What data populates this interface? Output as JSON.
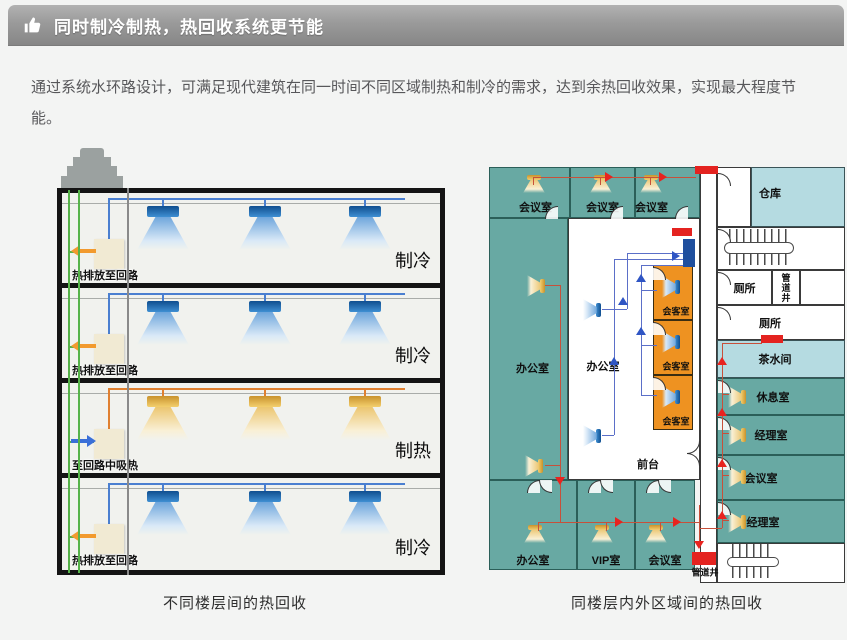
{
  "header": {
    "title": "同时制冷制热，热回收系统更节能"
  },
  "intro": {
    "text": "通过系统水环路设计，可满足现代建筑在同一时间不同区域制热和制冷的需求，达到余热回收效果，实现最大程度节能。"
  },
  "colors": {
    "header_grad_top": "#b2b2b2",
    "header_grad_bottom": "#868686",
    "page_bg": "#f3f4f3",
    "building_outline": "#141414",
    "green_pipe": "#57b34a",
    "gray_riser": "#8a8a8a",
    "cool_pipe": "#4a7fd0",
    "heat_pipe": "#e08030",
    "exchanger_box": "#f1ead3",
    "cool_arrow": "#f29a2e",
    "heat_arrow": "#3a6fd8",
    "teal_room": "#68a9a3",
    "ltblue_room": "#b5dbe1",
    "orange_room": "#ee9221",
    "loop_line_red": "#c7503a",
    "loop_line_blue": "#5b6fc8",
    "arrow_red": "#e8231f",
    "arrow_blue": "#2f55c4",
    "damper_red": "#e42320",
    "damper_blue": "#1f4f9e"
  },
  "left_diagram": {
    "caption": "不同楼层间的热回收",
    "floors": [
      {
        "mode": "制冷",
        "note": "热排放至回路",
        "variant": "cool"
      },
      {
        "mode": "制冷",
        "note": "热排放至回路",
        "variant": "cool"
      },
      {
        "mode": "制热",
        "note": "至回路中吸热",
        "variant": "heat"
      },
      {
        "mode": "制冷",
        "note": "热排放至回路",
        "variant": "cool"
      }
    ]
  },
  "right_diagram": {
    "caption": "同楼层内外区域间的热回收",
    "rooms": [
      {
        "label": "会议室",
        "x": 0,
        "y": 2,
        "w": 81,
        "h": 51,
        "fill": "teal",
        "ldx": 6,
        "ldy": 14,
        "cones": [
          {
            "x": 33,
            "y": 7,
            "c": "gold",
            "dir": "down"
          }
        ]
      },
      {
        "label": "会议室",
        "x": 81,
        "y": 2,
        "w": 65,
        "h": 51,
        "fill": "teal",
        "ldx": 0,
        "ldy": 14,
        "cones": [
          {
            "x": 19,
            "y": 7,
            "c": "gold",
            "dir": "down"
          }
        ]
      },
      {
        "label": "会议室",
        "x": 146,
        "y": 2,
        "w": 65,
        "h": 51,
        "fill": "teal",
        "ldx": -16,
        "ldy": 14,
        "cones": [
          {
            "x": 4,
            "y": 7,
            "c": "gold",
            "dir": "down"
          }
        ]
      },
      {
        "label": "办公室",
        "x": 0,
        "y": 53,
        "w": 79,
        "h": 262,
        "fill": "teal",
        "ldx": 4,
        "ldy": 19,
        "cones": [
          {
            "x": 35,
            "y": 58,
            "c": "gold",
            "dir": "side"
          },
          {
            "x": 33,
            "y": 238,
            "c": "gold",
            "dir": "side"
          }
        ]
      },
      {
        "label": "办公室",
        "x": 79,
        "y": 53,
        "w": 132,
        "h": 262,
        "fill": "white",
        "ldx": -31,
        "ldy": 17,
        "cones": [
          {
            "x": 12,
            "y": 82,
            "c": "blue",
            "dir": "side"
          },
          {
            "x": 12,
            "y": 208,
            "c": "blue",
            "dir": "side"
          }
        ]
      },
      {
        "label": "",
        "x": 211,
        "y": 2,
        "w": 17,
        "h": 416,
        "fill": "white"
      },
      {
        "label": "会客室",
        "x": 164,
        "y": 100,
        "w": 40,
        "h": 55,
        "fill": "orange",
        "fs": 9,
        "ldx": 3,
        "ldy": 18,
        "cones": [
          {
            "x": 6,
            "y": 12,
            "c": "blue",
            "dir": "side"
          }
        ]
      },
      {
        "label": "会客室",
        "x": 164,
        "y": 155,
        "w": 40,
        "h": 55,
        "fill": "orange",
        "fs": 9,
        "ldx": 3,
        "ldy": 18,
        "cones": [
          {
            "x": 6,
            "y": 12,
            "c": "blue",
            "dir": "side"
          }
        ]
      },
      {
        "label": "会客室",
        "x": 164,
        "y": 210,
        "w": 40,
        "h": 55,
        "fill": "orange",
        "fs": 9,
        "ldx": 3,
        "ldy": 18,
        "cones": [
          {
            "x": 6,
            "y": 12,
            "c": "blue",
            "dir": "side"
          }
        ]
      },
      {
        "label": "办公室",
        "x": 0,
        "y": 315,
        "w": 88,
        "h": 90,
        "fill": "teal",
        "ldy": 35,
        "cones": [
          {
            "x": 34,
            "y": 44,
            "c": "gold",
            "dir": "down"
          }
        ]
      },
      {
        "label": "VIP室",
        "x": 88,
        "y": 315,
        "w": 58,
        "h": 90,
        "fill": "teal",
        "ldy": 35,
        "cones": [
          {
            "x": 13,
            "y": 44,
            "c": "gold",
            "dir": "down"
          }
        ]
      },
      {
        "label": "会议室",
        "x": 146,
        "y": 315,
        "w": 60,
        "h": 90,
        "fill": "teal",
        "ldy": 35,
        "cones": [
          {
            "x": 9,
            "y": 44,
            "c": "gold",
            "dir": "down"
          }
        ]
      },
      {
        "label": "",
        "x": 228,
        "y": 2,
        "w": 34,
        "h": 60,
        "fill": "white"
      },
      {
        "label": "仓库",
        "x": 262,
        "y": 2,
        "w": 94,
        "h": 60,
        "fill": "ltblue",
        "ldx": -28,
        "ldy": -4
      },
      {
        "label": "",
        "x": 228,
        "y": 62,
        "w": 128,
        "h": 43,
        "fill": "white"
      },
      {
        "label": "厕所",
        "x": 228,
        "y": 105,
        "w": 55,
        "h": 35,
        "fill": "white"
      },
      {
        "label": "管道井",
        "x": 283,
        "y": 105,
        "w": 28,
        "h": 35,
        "fill": "white",
        "vertical": true,
        "fs": 9
      },
      {
        "label": "",
        "x": 311,
        "y": 105,
        "w": 45,
        "h": 35,
        "fill": "white"
      },
      {
        "label": "厕所",
        "x": 228,
        "y": 140,
        "w": 128,
        "h": 35,
        "fill": "white",
        "ldx": -11
      },
      {
        "label": "茶水间",
        "x": 228,
        "y": 175,
        "w": 128,
        "h": 38,
        "fill": "ltblue",
        "ldx": -6
      },
      {
        "label": "休息室",
        "x": 228,
        "y": 213,
        "w": 128,
        "h": 37,
        "fill": "teal",
        "ldx": -8,
        "cones": [
          {
            "x": 8,
            "y": 9,
            "c": "gold",
            "dir": "side"
          }
        ]
      },
      {
        "label": "经理室",
        "x": 228,
        "y": 250,
        "w": 128,
        "h": 40,
        "fill": "teal",
        "ldx": -10,
        "cones": [
          {
            "x": 8,
            "y": 10,
            "c": "gold",
            "dir": "side"
          }
        ]
      },
      {
        "label": "会议室",
        "x": 228,
        "y": 290,
        "w": 128,
        "h": 45,
        "fill": "teal",
        "ldx": -20,
        "cones": [
          {
            "x": 8,
            "y": 12,
            "c": "gold",
            "dir": "side"
          }
        ]
      },
      {
        "label": "经理室",
        "x": 228,
        "y": 335,
        "w": 128,
        "h": 43,
        "fill": "teal",
        "ldx": -18,
        "cones": [
          {
            "x": 8,
            "y": 12,
            "c": "gold",
            "dir": "side"
          }
        ]
      },
      {
        "label": "",
        "x": 228,
        "y": 378,
        "w": 128,
        "h": 40,
        "fill": "white"
      }
    ],
    "labels": [
      {
        "t": "前台",
        "x": 159,
        "y": 299,
        "fs": 11
      },
      {
        "t": "管道井",
        "x": 216,
        "y": 407,
        "fs": 9
      }
    ],
    "blocks": [
      {
        "x": 206,
        "y": 1,
        "w": 23,
        "h": 8,
        "c": "red"
      },
      {
        "x": 183,
        "y": 63,
        "w": 20,
        "h": 8,
        "c": "red"
      },
      {
        "x": 194,
        "y": 74,
        "w": 12,
        "h": 28,
        "c": "blue"
      },
      {
        "x": 272,
        "y": 170,
        "w": 22,
        "h": 8,
        "c": "red"
      },
      {
        "x": 203,
        "y": 387,
        "w": 24,
        "h": 13,
        "c": "red"
      }
    ],
    "lines": [
      {
        "x": 44,
        "y": 12,
        "w": 163,
        "h": 1,
        "c": "r"
      },
      {
        "x": 44,
        "y": 12,
        "w": 1,
        "h": 8,
        "c": "r"
      },
      {
        "x": 111,
        "y": 12,
        "w": 1,
        "h": 8,
        "c": "r"
      },
      {
        "x": 161,
        "y": 12,
        "w": 1,
        "h": 8,
        "c": "r"
      },
      {
        "x": 56,
        "y": 120,
        "w": 15,
        "h": 1,
        "c": "r"
      },
      {
        "x": 56,
        "y": 300,
        "w": 15,
        "h": 1,
        "c": "r"
      },
      {
        "x": 71,
        "y": 120,
        "w": 1,
        "h": 237,
        "c": "r"
      },
      {
        "x": 49,
        "y": 357,
        "w": 161,
        "h": 1,
        "c": "r"
      },
      {
        "x": 49,
        "y": 357,
        "w": 1,
        "h": 9,
        "c": "r"
      },
      {
        "x": 117,
        "y": 357,
        "w": 1,
        "h": 9,
        "c": "r"
      },
      {
        "x": 171,
        "y": 357,
        "w": 1,
        "h": 9,
        "c": "r"
      },
      {
        "x": 210,
        "y": 340,
        "w": 1,
        "h": 42,
        "c": "r"
      },
      {
        "x": 233,
        "y": 178,
        "w": 1,
        "h": 185,
        "c": "r"
      },
      {
        "x": 233,
        "y": 178,
        "w": 40,
        "h": 1,
        "c": "r"
      },
      {
        "x": 210,
        "y": 363,
        "w": 23,
        "h": 1,
        "c": "r"
      },
      {
        "x": 233,
        "y": 229,
        "w": 7,
        "h": 1,
        "c": "r"
      },
      {
        "x": 233,
        "y": 268,
        "w": 7,
        "h": 1,
        "c": "r"
      },
      {
        "x": 233,
        "y": 310,
        "w": 7,
        "h": 1,
        "c": "r"
      },
      {
        "x": 233,
        "y": 355,
        "w": 7,
        "h": 1,
        "c": "r"
      },
      {
        "x": 113,
        "y": 144,
        "w": 25,
        "h": 1,
        "c": "b"
      },
      {
        "x": 138,
        "y": 88,
        "w": 1,
        "h": 56,
        "c": "b"
      },
      {
        "x": 138,
        "y": 88,
        "w": 56,
        "h": 1,
        "c": "b"
      },
      {
        "x": 113,
        "y": 270,
        "w": 12,
        "h": 1,
        "c": "b"
      },
      {
        "x": 125,
        "y": 94,
        "w": 1,
        "h": 176,
        "c": "b"
      },
      {
        "x": 125,
        "y": 94,
        "w": 69,
        "h": 1,
        "c": "b"
      },
      {
        "x": 152,
        "y": 100,
        "w": 1,
        "h": 130,
        "c": "b"
      },
      {
        "x": 152,
        "y": 100,
        "w": 42,
        "h": 1,
        "c": "b"
      },
      {
        "x": 152,
        "y": 125,
        "w": 16,
        "h": 1,
        "c": "b"
      },
      {
        "x": 152,
        "y": 180,
        "w": 16,
        "h": 1,
        "c": "b"
      },
      {
        "x": 152,
        "y": 230,
        "w": 16,
        "h": 1,
        "c": "b"
      }
    ],
    "arrows": [
      {
        "x": 120,
        "y": 12,
        "d": "r",
        "c": "red"
      },
      {
        "x": 174,
        "y": 12,
        "d": "r",
        "c": "red"
      },
      {
        "x": 71,
        "y": 316,
        "d": "d",
        "c": "red"
      },
      {
        "x": 130,
        "y": 357,
        "d": "r",
        "c": "red"
      },
      {
        "x": 188,
        "y": 357,
        "d": "r",
        "c": "red"
      },
      {
        "x": 210,
        "y": 380,
        "d": "d",
        "c": "red"
      },
      {
        "x": 233,
        "y": 196,
        "d": "u",
        "c": "red"
      },
      {
        "x": 233,
        "y": 247,
        "d": "u",
        "c": "red"
      },
      {
        "x": 233,
        "y": 298,
        "d": "u",
        "c": "red"
      },
      {
        "x": 233,
        "y": 350,
        "d": "u",
        "c": "red"
      },
      {
        "x": 134,
        "y": 136,
        "d": "u",
        "c": "blue"
      },
      {
        "x": 125,
        "y": 196,
        "d": "u",
        "c": "blue"
      },
      {
        "x": 152,
        "y": 113,
        "d": "u",
        "c": "blue"
      },
      {
        "x": 152,
        "y": 166,
        "d": "u",
        "c": "blue"
      },
      {
        "x": 187,
        "y": 91,
        "d": "r",
        "c": "blue"
      }
    ],
    "doors": [
      {
        "x": 56,
        "y": 41,
        "r": 0
      },
      {
        "x": 121,
        "y": 41,
        "r": 0
      },
      {
        "x": 186,
        "y": 41,
        "r": 0
      },
      {
        "x": 229,
        "y": 8,
        "r": 90
      },
      {
        "x": 229,
        "y": 64,
        "r": 90
      },
      {
        "x": 229,
        "y": 107,
        "r": 90
      },
      {
        "x": 229,
        "y": 142,
        "r": 90
      },
      {
        "x": 229,
        "y": 215,
        "r": 90
      },
      {
        "x": 229,
        "y": 252,
        "r": 90
      },
      {
        "x": 229,
        "y": 292,
        "r": 90
      },
      {
        "x": 229,
        "y": 337,
        "r": 90
      },
      {
        "x": 164,
        "y": 102,
        "r": 90
      },
      {
        "x": 164,
        "y": 157,
        "r": 90
      },
      {
        "x": 164,
        "y": 212,
        "r": 90
      },
      {
        "x": 38,
        "y": 315,
        "r": 0
      },
      {
        "x": 50,
        "y": 315,
        "r": 270
      },
      {
        "x": 99,
        "y": 315,
        "r": 0
      },
      {
        "x": 111,
        "y": 315,
        "r": 270
      },
      {
        "x": 157,
        "y": 315,
        "r": 0
      },
      {
        "x": 169,
        "y": 315,
        "r": 270
      },
      {
        "x": 198,
        "y": 276,
        "r": 180
      },
      {
        "x": 198,
        "y": 288,
        "r": 90
      }
    ],
    "stairs": [
      {
        "x": 240,
        "y": 64,
        "w": 60,
        "h": 36
      },
      {
        "x": 243,
        "y": 379,
        "w": 42,
        "h": 34
      }
    ]
  }
}
